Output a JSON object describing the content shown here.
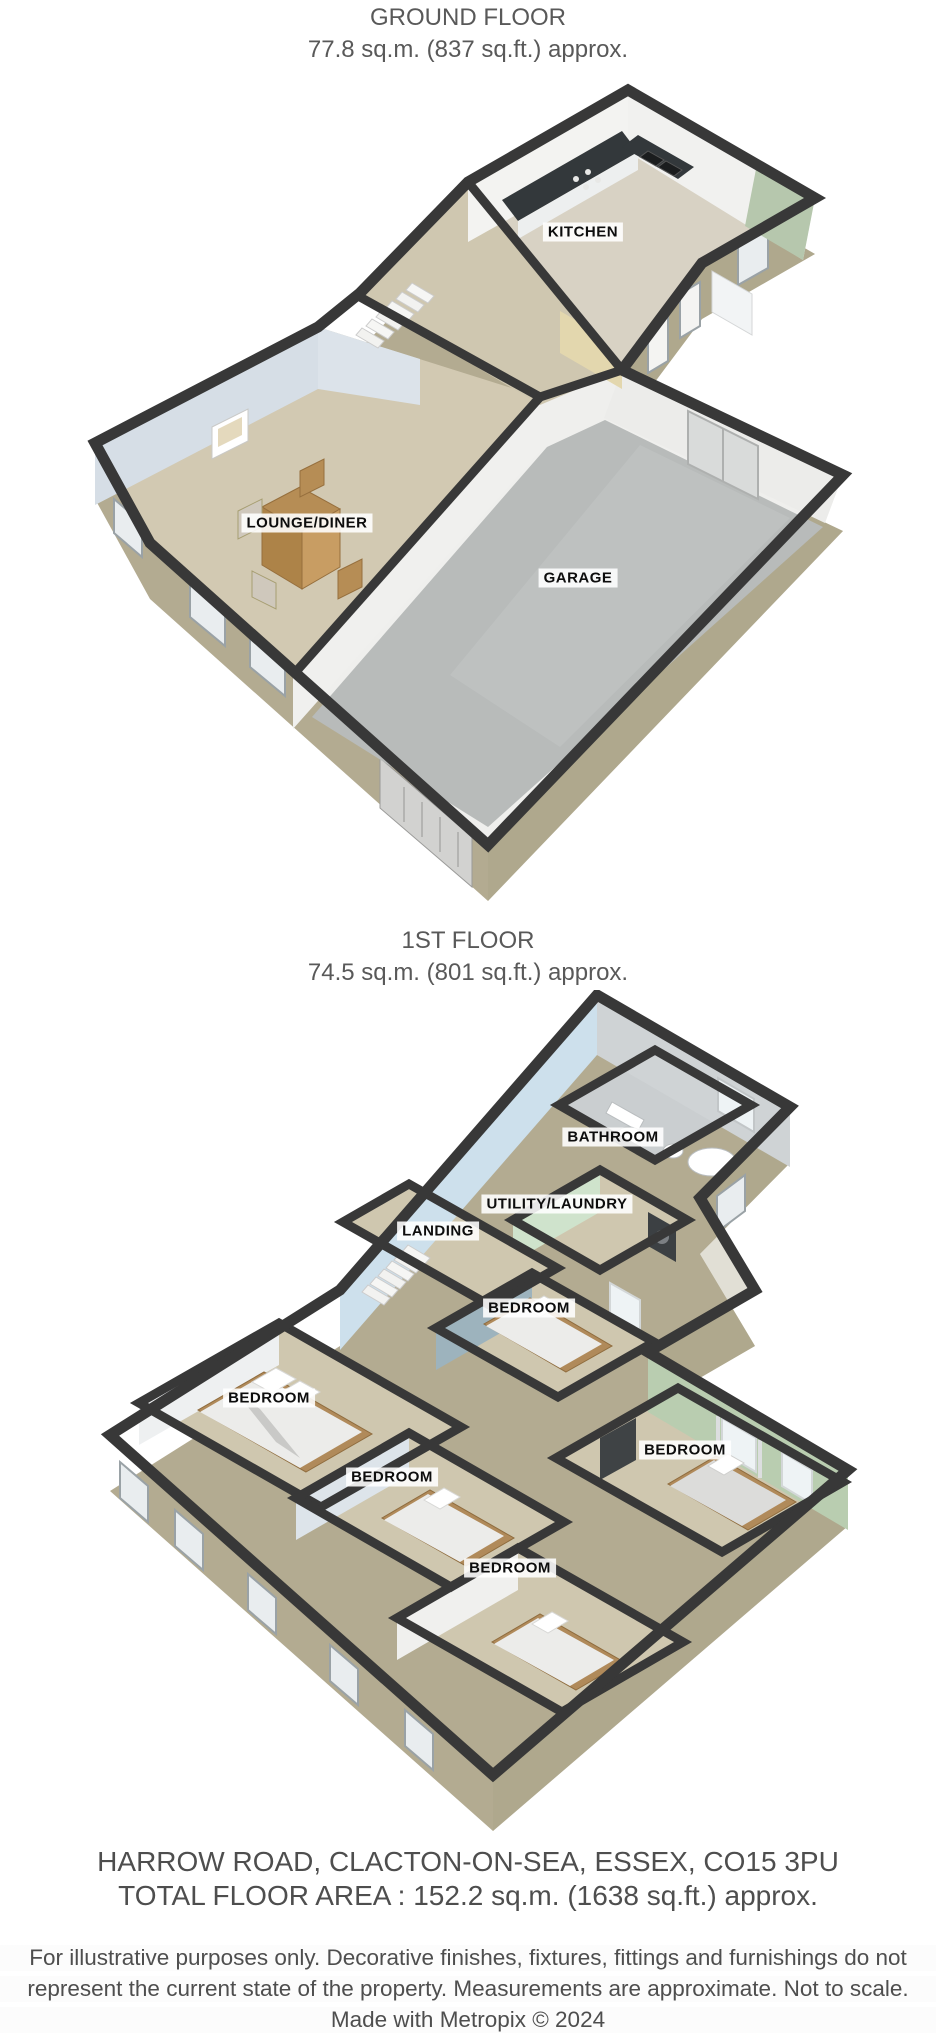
{
  "ground_floor": {
    "title": "GROUND FLOOR",
    "area": "77.8 sq.m. (837 sq.ft.) approx.",
    "labels": {
      "kitchen": "KITCHEN",
      "lounge": "LOUNGE/DINER",
      "garage": "GARAGE"
    }
  },
  "first_floor": {
    "title": "1ST FLOOR",
    "area": "74.5 sq.m. (801 sq.ft.) approx.",
    "labels": {
      "bathroom": "BATHROOM",
      "utility": "UTILITY/LAUNDRY",
      "landing": "LANDING",
      "bedroom_middle": "BEDROOM",
      "bedroom_left": "BEDROOM",
      "bedroom_right": "BEDROOM",
      "bedroom_center": "BEDROOM",
      "bedroom_bottom": "BEDROOM"
    }
  },
  "footer": {
    "address": "HARROW ROAD, CLACTON-ON-SEA, ESSEX, CO15 3PU",
    "total_area": "TOTAL FLOOR AREA : 152.2 sq.m. (1638 sq.ft.) approx.",
    "disclaimer_line1": "For illustrative purposes only. Decorative finishes, fixtures, fittings and furnishings do not",
    "disclaimer_line2": "represent the current state of the property. Measurements are approximate. Not to scale.",
    "credit": "Made with Metropix © 2024"
  },
  "colors": {
    "wall_cap": "#383838",
    "brick": "#b3ab91",
    "carpet": "#cfc7af",
    "concrete": "#b8bbba",
    "lounge_wall": "#d6dee6",
    "landing_wall": "#cde0ec",
    "green_wall": "#b9cdb0",
    "cream_wall": "#e3d7ae",
    "label_text": "#0d0d0d",
    "title_text": "#595959"
  }
}
